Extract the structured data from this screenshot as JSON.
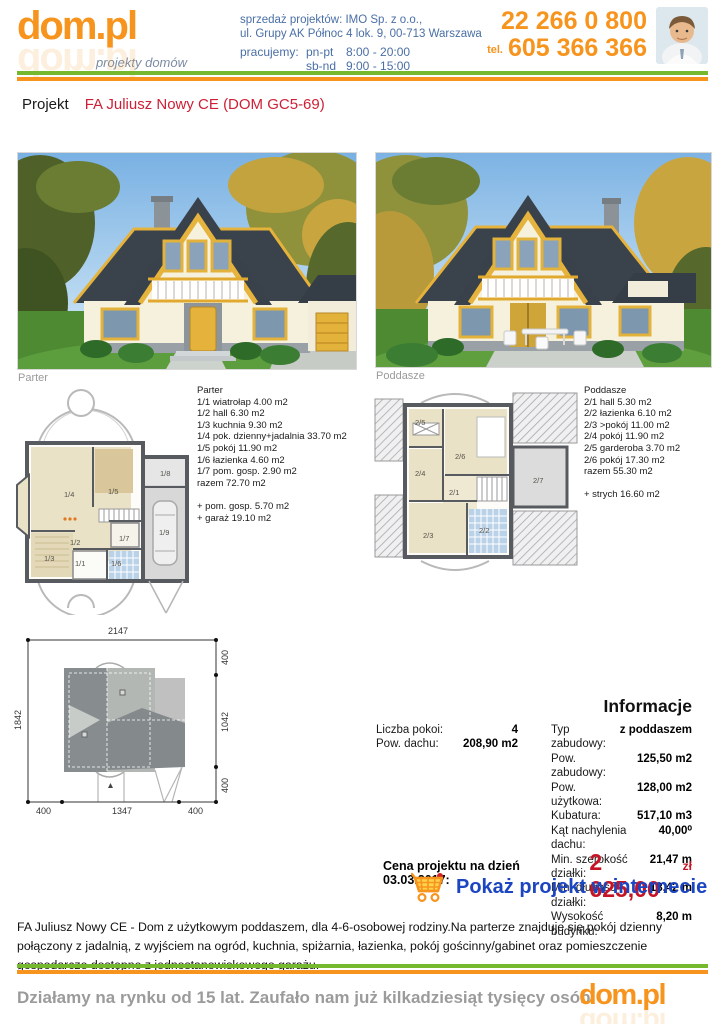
{
  "header": {
    "logo_text": "dom.pl",
    "logo_tagline": "projekty domów",
    "sales_line1": "sprzedaż projektów: IMO Sp. z o.o.,",
    "sales_line2": "ul. Grupy AK Północ 4 lok. 9, 00-713 Warszawa",
    "hours_label": "pracujemy:",
    "hours_weekdays_label": "pn-pt",
    "hours_weekdays": "8:00 - 20:00",
    "hours_weekend_label": "sb-nd",
    "hours_weekend": "9:00 - 15:00",
    "phone_main": "22 266 0 800",
    "phone_tel_label": "tel.",
    "phone_mobile": "605 366 366"
  },
  "project": {
    "label": "Projekt",
    "name": "FA Juliusz Nowy CE (DOM GC5-69)"
  },
  "photos": {
    "left_caption": "Parter",
    "right_caption": "Poddasze"
  },
  "floorplans": {
    "parter": {
      "title": "Parter",
      "rooms": [
        "1/1 wiatrołap 4.00 m2",
        "1/2 hall 6.30 m2",
        "1/3 kuchnia 9.30 m2",
        "1/4 pok. dzienny+jadalnia 33.70 m2",
        "1/5 pokój 11.90 m2",
        "1/6 łazienka 4.60 m2",
        "1/7 pom. gosp. 2.90 m2"
      ],
      "total": "razem 72.70 m2",
      "extras": [
        "+ pom. gosp. 5.70 m2",
        "+ garaż 19.10 m2"
      ],
      "plan_labels": [
        "1/1",
        "1/2",
        "1/3",
        "1/4",
        "1/5",
        "1/6",
        "1/7",
        "1/8",
        "1/9"
      ]
    },
    "poddasze": {
      "title": "Poddasze",
      "rooms": [
        "2/1 hall 5.30 m2",
        "2/2 łazienka 6.10 m2",
        "2/3 >pokój 11.00 m2",
        "2/4 pokój 11.90 m2",
        "2/5 garderoba 3.70 m2",
        "2/6 pokój 17.30 m2"
      ],
      "total": "razem 55.30 m2",
      "extras": [
        "+ strych 16.60 m2"
      ],
      "plan_labels": [
        "2/1",
        "2/2",
        "2/3",
        "2/4",
        "2/5",
        "2/6",
        "2/7"
      ]
    }
  },
  "siteplan": {
    "dim_top": "2147",
    "dim_left": "1842",
    "dim_right": [
      "400",
      "1042",
      "400"
    ],
    "dim_bottom": [
      "400",
      "1347",
      "400"
    ]
  },
  "info": {
    "title": "Informacje",
    "left_rows": [
      {
        "label": "Liczba pokoi:",
        "value": "4"
      },
      {
        "label": "Pow. dachu:",
        "value": "208,90 m2"
      }
    ],
    "right_rows": [
      {
        "label": "Typ zabudowy:",
        "value": "z poddaszem"
      },
      {
        "label": "Pow. zabudowy:",
        "value": "125,50 m2"
      },
      {
        "label": "Pow. użytkowa:",
        "value": "128,00 m2"
      },
      {
        "label": "Kubatura:",
        "value": "517,10 m3"
      },
      {
        "label": "Kąt nachylenia dachu:",
        "value": "40,00⁰"
      },
      {
        "label": "Min. szerokość działki:",
        "value": "21,47 m"
      },
      {
        "label": "Min. długość działki:",
        "value": "18,42 m"
      },
      {
        "label": "Wysokość budynku:",
        "value": "8,20 m"
      }
    ]
  },
  "price": {
    "label": "Cena projektu na dzień 03.03.2017:",
    "value": "2 625,00",
    "currency": "zł",
    "link_label": "Pokaż projekt w internecie"
  },
  "description": "FA Juliusz Nowy CE - Dom z użytkowym poddaszem, dla 4-6-osobowej rodziny.Na parterze znajduje się pokój dzienny połączony z jadalnią, z wyjściem na ogród, kuchnia, spiżarnia, łazienka, pokój gościnny/gabinet oraz pomieszczenie gospodarcze dostępne z jednostanowiskowego garażu.",
  "footer": {
    "text": "Działamy na rynku od 15 lat. Zaufało nam już kilkadziesiąt tysięcy osób.",
    "logo_text": "dom.pl"
  },
  "colors": {
    "accent_orange": "#f7941d",
    "rule_green": "#76b82e",
    "header_blue": "#4a6fa5",
    "project_red": "#cd2036",
    "price_red": "#c41425",
    "link_blue": "#1c45c2",
    "caption_gray": "#9a9a9a"
  }
}
